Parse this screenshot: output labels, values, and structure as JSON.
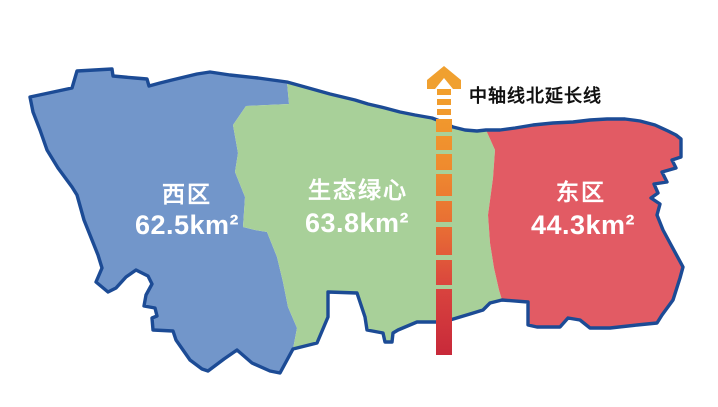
{
  "map": {
    "border_color": "#1c4b95",
    "background": "#ffffff"
  },
  "regions": [
    {
      "name": "西区",
      "area": "62.5km²",
      "color": "#7296ca"
    },
    {
      "name": "生态绿心",
      "area": "63.8km²",
      "color": "#a8d099"
    },
    {
      "name": "东区",
      "area": "44.3km²",
      "color": "#e25b64"
    }
  ],
  "axis": {
    "label": "中轴线北延长线",
    "label_color": "#111111",
    "arrow_color": "#f0a02f",
    "gradient": [
      "#f2a12c",
      "#ef8b2e",
      "#e76a35",
      "#d9443e",
      "#c8293a"
    ]
  }
}
